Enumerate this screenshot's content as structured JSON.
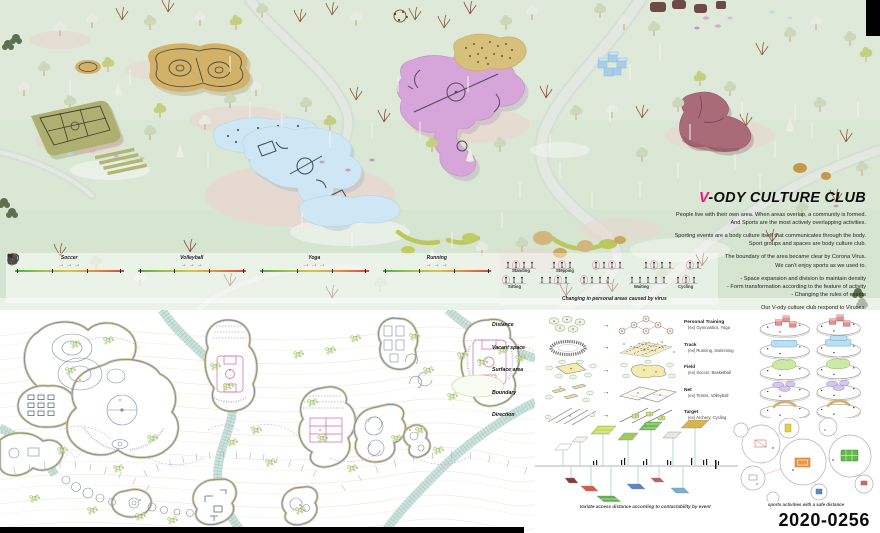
{
  "palette": {
    "accent_pink": "#e8187e",
    "mint_terrain": "#dbe8d6",
    "tan_building": "#d2b269",
    "blue_building": "#cfe7f5",
    "pink_building": "#d6a5da",
    "mauve_building": "#a96b78",
    "olive_court": "#adb071",
    "safe_green": "#4fae48",
    "risk_red": "#d24840"
  },
  "header": {
    "title_v": "V",
    "title_rest": "-ODY CULTURE CLUB",
    "paragraphs": [
      [
        "People live with their own area.  When areas overlap, a community is formed.",
        "And Sports are the most actively overlapping activities."
      ],
      [
        "Sporting events are a body culture itself that communicates through the body.",
        "Sport groups and spaces are body culture club."
      ],
      [
        "The boundary of the area became clear by Corona Virus.",
        "We can't enjoy sports as we used to."
      ],
      [
        "-  Space expansion and division to maintain density",
        "-  Form transformation according to the feature of activity",
        "-  Changing the rules of events"
      ],
      [
        "Our V-ody culture club respond to Viruses."
      ]
    ]
  },
  "sports_strip": {
    "sports": [
      {
        "name": "Soccer"
      },
      {
        "name": "Volleyball"
      },
      {
        "name": "Yoga"
      },
      {
        "name": "Running"
      }
    ]
  },
  "postures": {
    "labels": [
      "Standing",
      "Stepping",
      "Sitting",
      "Waiting",
      "Cycling"
    ],
    "caption": "Changing in personal areas caused by virus"
  },
  "morphology": {
    "rows": [
      {
        "label": "Distance",
        "category": "Personal Training",
        "example": "(ex) Gymnastics, Yoga"
      },
      {
        "label": "Vacant space",
        "category": "Track",
        "example": "(ex) Running, Swimming"
      },
      {
        "label": "Surface area",
        "category": "Field",
        "example": "(ex) Soccer, Basketball"
      },
      {
        "label": "Boundary",
        "category": "Net",
        "example": "(ex) Tennis, Volleyball"
      },
      {
        "label": "Direction",
        "category": "Target",
        "example": "(ex) Archery, Cycling"
      }
    ]
  },
  "timeline": {
    "caption": "Variate access distance  according to contactability by event"
  },
  "platters": {
    "caption": "sports activities with a safe distance"
  },
  "entry_code": "2020-0256",
  "icons": {
    "arrow": "→"
  }
}
